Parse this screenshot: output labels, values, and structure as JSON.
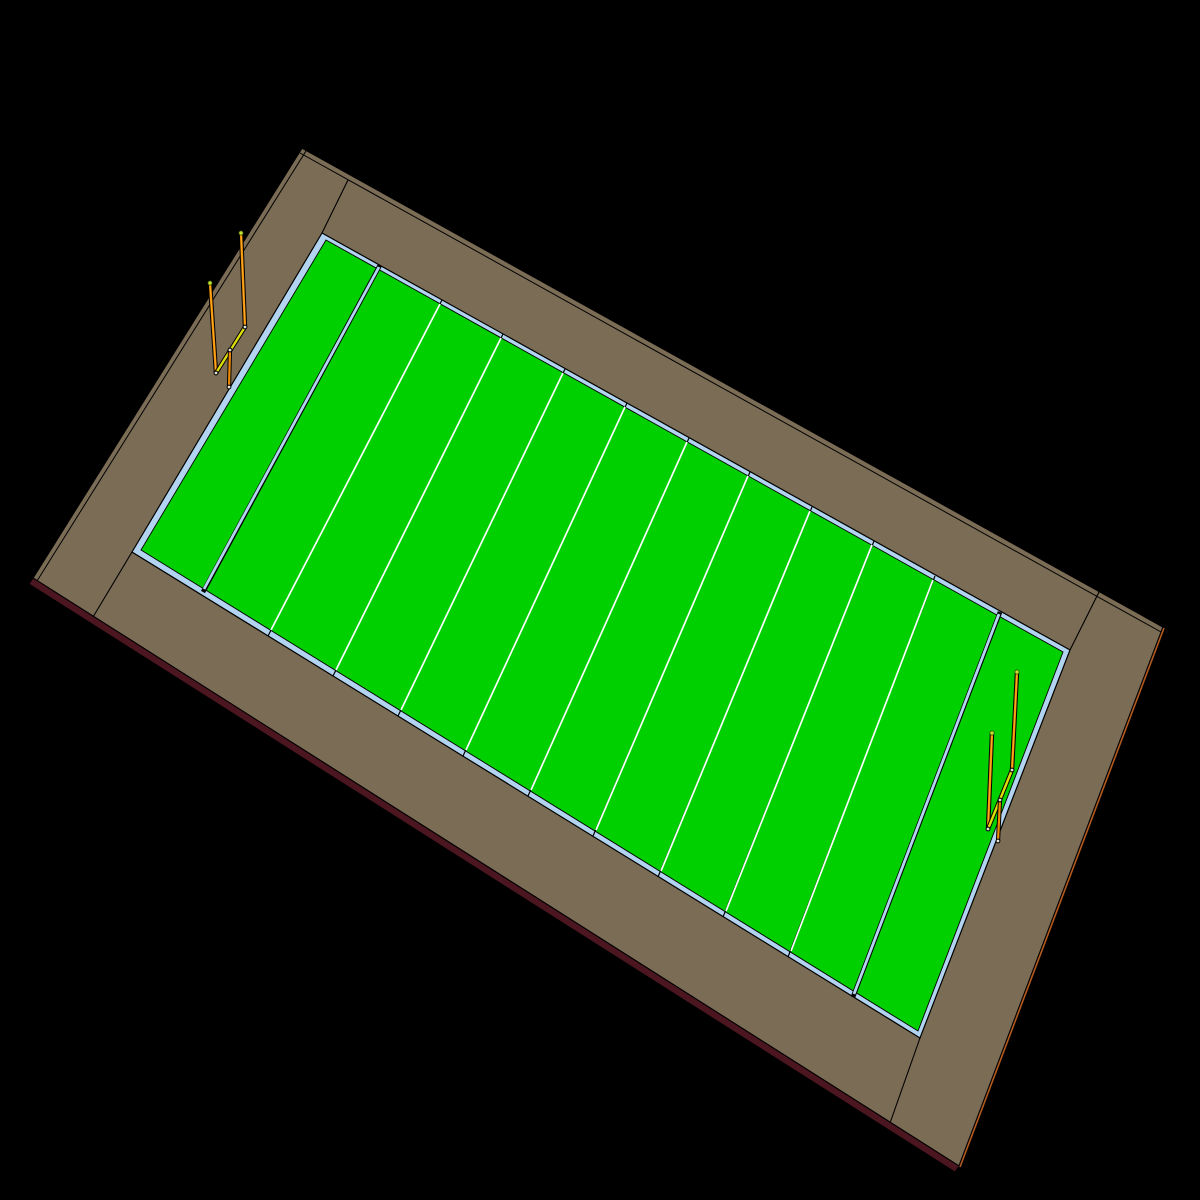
{
  "scene": {
    "description": "3D CAD-style render of an American football field model viewed at an angle on a black viewport background",
    "canvas": {
      "width": 1200,
      "height": 1200,
      "background": "#000000"
    },
    "palette": {
      "edge": "#000000",
      "frame_brown": "#7B6C55",
      "base_maroon": "#4B1620",
      "rim_orange": "#B45A1E",
      "sideline_blue": "#B3D4F0",
      "turf_green": "#00D000",
      "line_white": "#FFFFFF",
      "post_orange": "#EF8A00",
      "post_highlight": "#FFB52E",
      "crossbar_yellow": "#EDDB00",
      "crossbar_highlight": "#C4E414",
      "node_fill": "#E3E3D2",
      "tip_lime": "#BFE232",
      "tip_edge": "#2E4400"
    },
    "field_facts": {
      "yard_line_count": 9,
      "goal_line_count": 2,
      "end_zone_count": 2,
      "goal_post_count": 2
    },
    "layers": [
      {
        "name": "frame-top-face",
        "type": "polygon",
        "points": [
          [
            302,
            148
          ],
          [
            1163,
            627
          ],
          [
            959,
            1166
          ],
          [
            33,
            578
          ]
        ],
        "fill": "frame_brown",
        "stroke": "edge",
        "w": 1.3
      },
      {
        "name": "frame-top-bevel-edge",
        "type": "line",
        "p1": [
          300,
          153
        ],
        "p2": [
          1161,
          632
        ],
        "stroke": "edge",
        "w": 1
      },
      {
        "name": "frame-left-bevel-edge",
        "type": "line",
        "p1": [
          306,
          151
        ],
        "p2": [
          37,
          581
        ],
        "stroke": "edge",
        "w": 1
      },
      {
        "name": "base-maroon-side-face",
        "type": "polygon",
        "points": [
          [
            33,
            578
          ],
          [
            959,
            1166
          ],
          [
            955,
            1172
          ],
          [
            29,
            584
          ]
        ],
        "fill": "base_maroon",
        "stroke": "edge",
        "w": 1
      },
      {
        "name": "frame-right-rim-edge",
        "type": "line",
        "p1": [
          960,
          1167
        ],
        "p2": [
          1164,
          628
        ],
        "stroke": "rim_orange",
        "w": 1.6
      },
      {
        "name": "frame-corner-joint-top",
        "type": "line",
        "p1": [
          348,
          180
        ],
        "p2": [
          322,
          233
        ],
        "stroke": "edge",
        "w": 1.1
      },
      {
        "name": "frame-corner-joint-right",
        "type": "line",
        "p1": [
          1100,
          590
        ],
        "p2": [
          1070,
          650
        ],
        "stroke": "edge",
        "w": 1.1
      },
      {
        "name": "frame-corner-joint-bottom",
        "type": "line",
        "p1": [
          920,
          1038
        ],
        "p2": [
          890,
          1123
        ],
        "stroke": "edge",
        "w": 1.1
      },
      {
        "name": "frame-corner-joint-left",
        "type": "line",
        "p1": [
          132,
          552
        ],
        "p2": [
          93,
          617
        ],
        "stroke": "edge",
        "w": 1.1
      },
      {
        "name": "field-sideline-border",
        "type": "polygon",
        "points": [
          [
            322,
            233
          ],
          [
            1070,
            650
          ],
          [
            920,
            1038
          ],
          [
            132,
            552
          ]
        ],
        "fill": "sideline_blue",
        "stroke": "edge",
        "w": 1.2
      },
      {
        "name": "field-turf",
        "type": "polygon",
        "points": [
          [
            326,
            240
          ],
          [
            1063,
            652
          ],
          [
            918,
            1031
          ],
          [
            141,
            550
          ]
        ],
        "fill": "turf_green",
        "stroke": "edge",
        "w": 0.9
      },
      {
        "name": "goal-line-left-edge",
        "type": "line",
        "p1": [
          380,
          265
        ],
        "p2": [
          203,
          592
        ],
        "stroke": "edge",
        "w": 4.6
      },
      {
        "name": "goal-line-left",
        "type": "line",
        "p1": [
          379,
          267
        ],
        "p2": [
          204,
          589
        ],
        "stroke": "sideline_blue",
        "w": 2.8
      },
      {
        "name": "goal-line-right-edge",
        "type": "line",
        "p1": [
          1000,
          612
        ],
        "p2": [
          853,
          997
        ],
        "stroke": "edge",
        "w": 4.6
      },
      {
        "name": "goal-line-right",
        "type": "line",
        "p1": [
          999,
          614
        ],
        "p2": [
          854,
          994
        ],
        "stroke": "sideline_blue",
        "w": 2.8
      },
      {
        "name": "yard-line-1-tick",
        "type": "line",
        "p1": [
          442,
          300
        ],
        "p2": [
          268,
          636
        ],
        "stroke": "edge",
        "w": 1.2
      },
      {
        "name": "yard-line-1",
        "type": "line",
        "p1": [
          440,
          304
        ],
        "p2": [
          271,
          630
        ],
        "stroke": "line_white",
        "w": 1.7
      },
      {
        "name": "yard-line-2-tick",
        "type": "line",
        "p1": [
          503,
          334
        ],
        "p2": [
          333,
          676
        ],
        "stroke": "edge",
        "w": 1.2
      },
      {
        "name": "yard-line-2",
        "type": "line",
        "p1": [
          501,
          338
        ],
        "p2": [
          336,
          670
        ],
        "stroke": "line_white",
        "w": 1.7
      },
      {
        "name": "yard-line-3-tick",
        "type": "line",
        "p1": [
          565,
          369
        ],
        "p2": [
          398,
          716
        ],
        "stroke": "edge",
        "w": 1.2
      },
      {
        "name": "yard-line-3",
        "type": "line",
        "p1": [
          563,
          373
        ],
        "p2": [
          401,
          710
        ],
        "stroke": "line_white",
        "w": 1.7
      },
      {
        "name": "yard-line-4-tick",
        "type": "line",
        "p1": [
          627,
          403
        ],
        "p2": [
          463,
          756
        ],
        "stroke": "edge",
        "w": 1.2
      },
      {
        "name": "yard-line-4",
        "type": "line",
        "p1": [
          625,
          407
        ],
        "p2": [
          466,
          750
        ],
        "stroke": "line_white",
        "w": 1.7
      },
      {
        "name": "yard-line-5-tick",
        "type": "line",
        "p1": [
          689,
          438
        ],
        "p2": [
          528,
          796
        ],
        "stroke": "edge",
        "w": 1.2
      },
      {
        "name": "yard-line-5",
        "type": "line",
        "p1": [
          687,
          442
        ],
        "p2": [
          531,
          790
        ],
        "stroke": "line_white",
        "w": 1.7
      },
      {
        "name": "yard-line-6-tick",
        "type": "line",
        "p1": [
          750,
          472
        ],
        "p2": [
          593,
          836
        ],
        "stroke": "edge",
        "w": 1.2
      },
      {
        "name": "yard-line-6",
        "type": "line",
        "p1": [
          748,
          476
        ],
        "p2": [
          596,
          830
        ],
        "stroke": "line_white",
        "w": 1.7
      },
      {
        "name": "yard-line-7-tick",
        "type": "line",
        "p1": [
          812,
          507
        ],
        "p2": [
          658,
          877
        ],
        "stroke": "edge",
        "w": 1.2
      },
      {
        "name": "yard-line-7",
        "type": "line",
        "p1": [
          810,
          511
        ],
        "p2": [
          661,
          871
        ],
        "stroke": "line_white",
        "w": 1.7
      },
      {
        "name": "yard-line-8-tick",
        "type": "line",
        "p1": [
          874,
          541
        ],
        "p2": [
          723,
          917
        ],
        "stroke": "edge",
        "w": 1.2
      },
      {
        "name": "yard-line-8",
        "type": "line",
        "p1": [
          872,
          545
        ],
        "p2": [
          726,
          911
        ],
        "stroke": "line_white",
        "w": 1.7
      },
      {
        "name": "yard-line-9-tick",
        "type": "line",
        "p1": [
          935,
          576
        ],
        "p2": [
          788,
          957
        ],
        "stroke": "edge",
        "w": 1.2
      },
      {
        "name": "yard-line-9",
        "type": "line",
        "p1": [
          933,
          580
        ],
        "p2": [
          791,
          951
        ],
        "stroke": "line_white",
        "w": 1.7
      },
      {
        "name": "goalpost-left-far-upright-outline",
        "type": "line",
        "p1": [
          216,
          373
        ],
        "p2": [
          210,
          283
        ],
        "stroke": "edge",
        "w": 4.4,
        "cap": "round"
      },
      {
        "name": "goalpost-left-far-upright",
        "type": "line",
        "p1": [
          216,
          373
        ],
        "p2": [
          210,
          283
        ],
        "stroke": "post_orange",
        "w": 2.4,
        "cap": "round"
      },
      {
        "name": "goalpost-left-far-upright-highlight",
        "type": "line",
        "p1": [
          216,
          372
        ],
        "p2": [
          210,
          284
        ],
        "stroke": "post_highlight",
        "w": 0.8,
        "cap": "round"
      },
      {
        "name": "goalpost-left-crossbar-outline",
        "type": "line",
        "p1": [
          245,
          327
        ],
        "p2": [
          216,
          373
        ],
        "stroke": "edge",
        "w": 4.4,
        "cap": "round"
      },
      {
        "name": "goalpost-left-crossbar",
        "type": "line",
        "p1": [
          245,
          327
        ],
        "p2": [
          216,
          373
        ],
        "stroke": "crossbar_yellow",
        "w": 2.4,
        "cap": "round"
      },
      {
        "name": "goalpost-left-crossbar-highlight",
        "type": "line",
        "p1": [
          244,
          329
        ],
        "p2": [
          218,
          370
        ],
        "stroke": "crossbar_highlight",
        "w": 0.8,
        "cap": "round"
      },
      {
        "name": "goalpost-left-center-post-outline",
        "type": "line",
        "p1": [
          230,
          350
        ],
        "p2": [
          229,
          387
        ],
        "stroke": "edge",
        "w": 4.2,
        "cap": "round"
      },
      {
        "name": "goalpost-left-center-post",
        "type": "line",
        "p1": [
          230,
          350
        ],
        "p2": [
          229,
          387
        ],
        "stroke": "post_orange",
        "w": 2.2,
        "cap": "round"
      },
      {
        "name": "goalpost-left-near-upright-outline",
        "type": "line",
        "p1": [
          245,
          327
        ],
        "p2": [
          241,
          233
        ],
        "stroke": "edge",
        "w": 4.4,
        "cap": "round"
      },
      {
        "name": "goalpost-left-near-upright",
        "type": "line",
        "p1": [
          245,
          327
        ],
        "p2": [
          241,
          233
        ],
        "stroke": "post_orange",
        "w": 2.4,
        "cap": "round"
      },
      {
        "name": "goalpost-left-near-upright-highlight",
        "type": "line",
        "p1": [
          245,
          326
        ],
        "p2": [
          241,
          234
        ],
        "stroke": "post_highlight",
        "w": 0.8,
        "cap": "round"
      },
      {
        "name": "goalpost-left-joint-node-a",
        "type": "circle",
        "c": [
          245,
          327
        ],
        "r": 1.9,
        "fill": "node_fill",
        "stroke": "edge",
        "w": 1
      },
      {
        "name": "goalpost-left-joint-node-b",
        "type": "circle",
        "c": [
          230,
          350
        ],
        "r": 1.9,
        "fill": "node_fill",
        "stroke": "edge",
        "w": 1
      },
      {
        "name": "goalpost-left-joint-node-c",
        "type": "circle",
        "c": [
          216,
          373
        ],
        "r": 1.9,
        "fill": "node_fill",
        "stroke": "edge",
        "w": 1
      },
      {
        "name": "goalpost-left-joint-node-d",
        "type": "circle",
        "c": [
          229,
          387
        ],
        "r": 1.9,
        "fill": "node_fill",
        "stroke": "edge",
        "w": 1
      },
      {
        "name": "goalpost-left-tip-near",
        "type": "circle",
        "c": [
          241,
          233
        ],
        "r": 2.1,
        "fill": "tip_lime",
        "stroke": "tip_edge",
        "w": 0.7
      },
      {
        "name": "goalpost-left-tip-far",
        "type": "circle",
        "c": [
          210,
          283
        ],
        "r": 2.1,
        "fill": "tip_lime",
        "stroke": "tip_edge",
        "w": 0.7
      },
      {
        "name": "goalpost-right-far-upright-outline",
        "type": "line",
        "p1": [
          988,
          829
        ],
        "p2": [
          992,
          733
        ],
        "stroke": "edge",
        "w": 4.4,
        "cap": "round"
      },
      {
        "name": "goalpost-right-far-upright",
        "type": "line",
        "p1": [
          988,
          829
        ],
        "p2": [
          992,
          733
        ],
        "stroke": "post_orange",
        "w": 2.4,
        "cap": "round"
      },
      {
        "name": "goalpost-right-far-upright-highlight",
        "type": "line",
        "p1": [
          988,
          828
        ],
        "p2": [
          992,
          734
        ],
        "stroke": "post_highlight",
        "w": 0.8,
        "cap": "round"
      },
      {
        "name": "goalpost-right-crossbar-outline",
        "type": "line",
        "p1": [
          1012,
          770
        ],
        "p2": [
          988,
          829
        ],
        "stroke": "edge",
        "w": 4.4,
        "cap": "round"
      },
      {
        "name": "goalpost-right-crossbar",
        "type": "line",
        "p1": [
          1012,
          770
        ],
        "p2": [
          988,
          829
        ],
        "stroke": "crossbar_yellow",
        "w": 2.4,
        "cap": "round"
      },
      {
        "name": "goalpost-right-crossbar-highlight",
        "type": "line",
        "p1": [
          1011,
          772
        ],
        "p2": [
          990,
          826
        ],
        "stroke": "crossbar_highlight",
        "w": 0.8,
        "cap": "round"
      },
      {
        "name": "goalpost-right-center-post-outline",
        "type": "line",
        "p1": [
          1000,
          800
        ],
        "p2": [
          998,
          841
        ],
        "stroke": "edge",
        "w": 4.2,
        "cap": "round"
      },
      {
        "name": "goalpost-right-center-post",
        "type": "line",
        "p1": [
          1000,
          800
        ],
        "p2": [
          998,
          841
        ],
        "stroke": "post_orange",
        "w": 2.2,
        "cap": "round"
      },
      {
        "name": "goalpost-right-near-upright-outline",
        "type": "line",
        "p1": [
          1012,
          770
        ],
        "p2": [
          1017,
          672
        ],
        "stroke": "edge",
        "w": 4.4,
        "cap": "round"
      },
      {
        "name": "goalpost-right-near-upright",
        "type": "line",
        "p1": [
          1012,
          770
        ],
        "p2": [
          1017,
          672
        ],
        "stroke": "post_orange",
        "w": 2.4,
        "cap": "round"
      },
      {
        "name": "goalpost-right-near-upright-highlight",
        "type": "line",
        "p1": [
          1012,
          769
        ],
        "p2": [
          1017,
          673
        ],
        "stroke": "post_highlight",
        "w": 0.8,
        "cap": "round"
      },
      {
        "name": "goalpost-right-joint-node-a",
        "type": "circle",
        "c": [
          1012,
          770
        ],
        "r": 1.9,
        "fill": "node_fill",
        "stroke": "edge",
        "w": 1
      },
      {
        "name": "goalpost-right-joint-node-b",
        "type": "circle",
        "c": [
          1000,
          800
        ],
        "r": 1.9,
        "fill": "node_fill",
        "stroke": "edge",
        "w": 1
      },
      {
        "name": "goalpost-right-joint-node-c",
        "type": "circle",
        "c": [
          988,
          829
        ],
        "r": 1.9,
        "fill": "node_fill",
        "stroke": "edge",
        "w": 1
      },
      {
        "name": "goalpost-right-joint-node-d",
        "type": "circle",
        "c": [
          998,
          841
        ],
        "r": 1.9,
        "fill": "node_fill",
        "stroke": "edge",
        "w": 1
      },
      {
        "name": "goalpost-right-tip-near",
        "type": "circle",
        "c": [
          1017,
          672
        ],
        "r": 2.1,
        "fill": "tip_lime",
        "stroke": "tip_edge",
        "w": 0.7
      },
      {
        "name": "goalpost-right-tip-far",
        "type": "circle",
        "c": [
          992,
          733
        ],
        "r": 2.1,
        "fill": "tip_lime",
        "stroke": "tip_edge",
        "w": 0.7
      }
    ]
  }
}
